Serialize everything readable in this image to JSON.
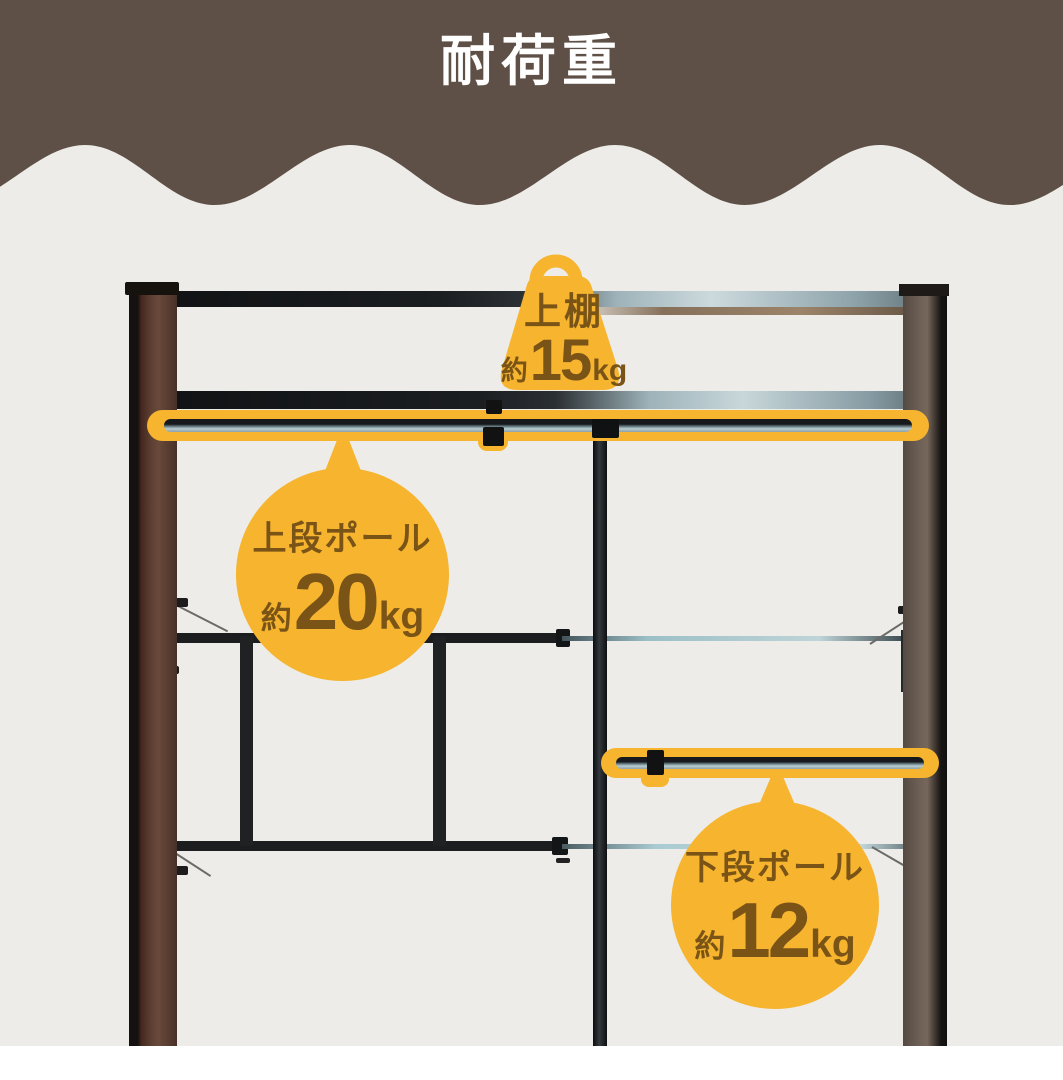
{
  "header": {
    "title": "耐荷重"
  },
  "theme": {
    "header-bg": "#5e5047",
    "header-text": "#ffffff",
    "photo-bg": "#edece8",
    "accent": "#f6b42f",
    "accent-text": "#7a5416",
    "frame-dark": "#1b1d1f",
    "pole-silver": "#aac9ce",
    "wood-left": "#5f4134",
    "wood-right": "#6f6156"
  },
  "callouts": {
    "top_shelf": {
      "label": "上棚",
      "prefix": "約",
      "value": "15",
      "unit": "kg"
    },
    "upper_pole": {
      "label": "上段ポール",
      "prefix": "約",
      "value": "20",
      "unit": "kg"
    },
    "lower_pole": {
      "label": "下段ポール",
      "prefix": "約",
      "value": "12",
      "unit": "kg"
    }
  }
}
